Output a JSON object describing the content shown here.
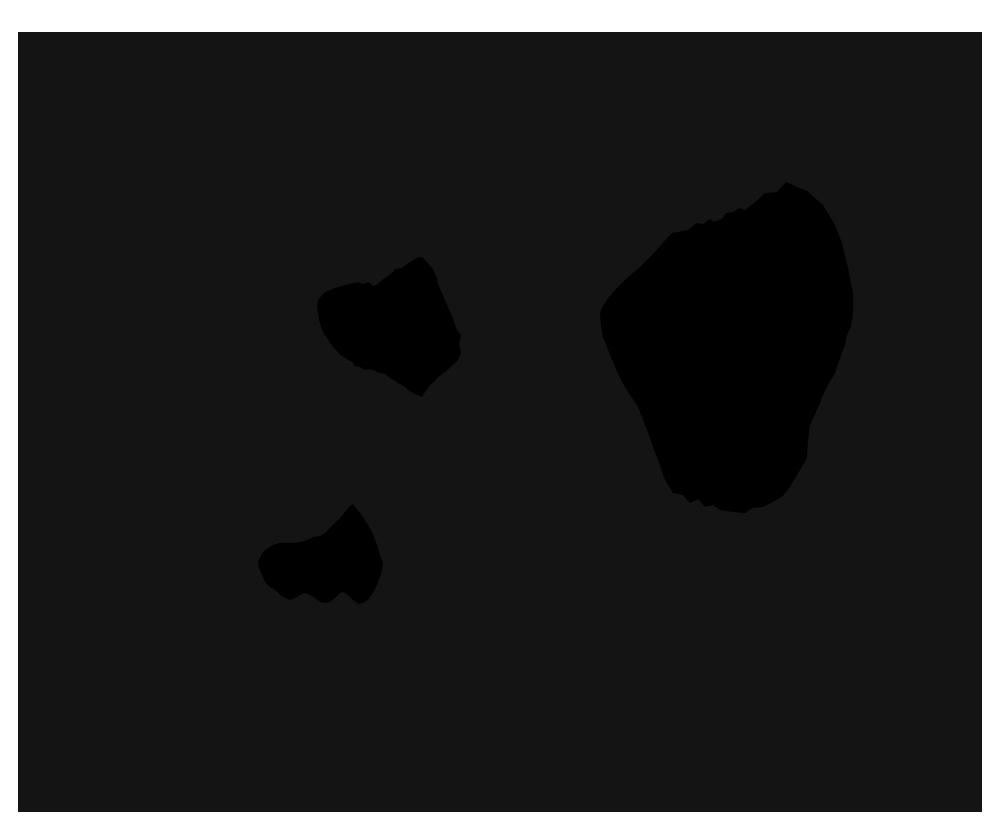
{
  "figure": {
    "width": 1000,
    "height": 836,
    "page_background": "#ffffff"
  },
  "image": {
    "x": 18,
    "y": 32,
    "width": 964,
    "height": 780,
    "background_color": "#141414",
    "silhouette_color": "#000000",
    "blobs": [
      {
        "name": "blob-medium-upper-middle",
        "points": "404,225 415,237 419,246 420,252 426,266 430,275 434,284 439,298 443,303 441,313 443,320 440,328 434,334 427,340 420,345 416,350 413,352 407,360 404,365 397,362 390,358 387,355 382,352 377,349 372,346 367,342 362,341 357,339 352,337 347,338 342,335 337,334 334,330 330,328 327,326 322,323 320,320 316,316 312,311 309,306 305,300 303,295 301,288 300,281 299,275 300,268 307,260 317,256 327,253 337,251 340,250 345,252 351,250 355,254 359,253 364,248 370,244 375,240 377,237 384,236 389,232 394,229 399,226"
      },
      {
        "name": "blob-large-right",
        "points": "768,150 777,154 789,159 805,173 817,193 824,211 830,236 835,261 835,280 833,295 829,303 827,313 825,318 817,341 810,353 805,363 799,378 792,393 790,408 789,426 782,438 772,455 764,465 755,470 745,475 735,476 727,481 715,480 702,478 695,473 687,475 680,467 672,471 665,463 655,461 647,448 640,428 635,415 629,398 624,385 619,373 612,363 607,355 602,346 597,335 593,325 589,315 585,305 583,295 582,281 585,274 591,265 597,258 609,246 622,235 637,220 650,205 654,201 670,198 679,191 685,192 692,187 696,190 705,186 708,181 715,180 721,176 727,178 737,170 747,161 759,160"
      },
      {
        "name": "blob-small-lower-left",
        "points": "335,472 339,477 345,485 350,493 354,500 358,510 360,516 362,523 365,531 364,538 362,545 359,553 355,561 350,568 345,571 340,572 335,568 330,563 325,560 322,561 317,566 312,570 307,571 302,570 297,566 292,563 287,561 282,563 277,566 272,568 267,566 262,563 257,558 252,555 247,550 244,543 241,536 240,530 242,525 245,520 250,516 255,513 262,511 269,511 275,511 282,510 289,508 295,505 302,504 307,501 312,496 317,491 322,486 327,480 331,475"
      }
    ]
  }
}
